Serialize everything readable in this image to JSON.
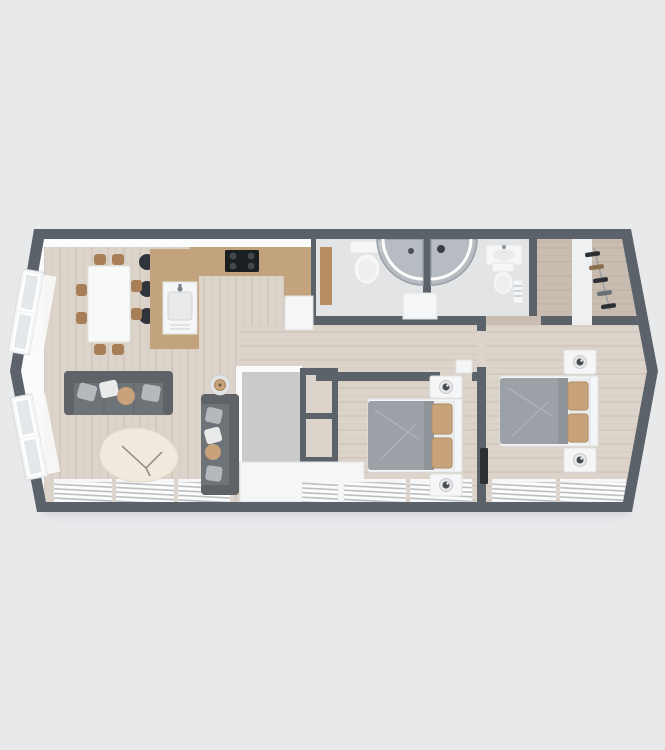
{
  "canvas": {
    "width": 665,
    "height": 750
  },
  "palette": {
    "bg": "#e8e9eb",
    "wall": "#5c6269",
    "wallFace": "#fafbfb",
    "floorMain": "#dcd4ca",
    "floorBath": "#e2e4e6",
    "floorDress": "#c9bdb1",
    "floorNook": "#c9cacc",
    "wood": "#c3a37d",
    "woodTrim": "#b68e62",
    "chairWood": "#a87f56",
    "white": "#f5f6f7",
    "sofa": "#6e7377",
    "sofaDark": "#5f6367",
    "cushionGray": "#b5b9be",
    "cushionWhite": "#e9eaea",
    "tan": "#c7a27a",
    "duvet": "#9ba1a6",
    "duvetFold": "#b2b8bc",
    "dark": "#2c3034",
    "glass": "rgba(130,140,150,0.45)",
    "stripe": "#b9bdc0",
    "rug": "#f0eade",
    "plank": "rgba(135,110,85,0.10)"
  },
  "scene": {
    "type": "3d-floorplan-top-down-render",
    "building": "single-storey-holiday-lodge",
    "rooms": [
      {
        "name": "open-plan-living-kitchen-diner",
        "furniture": [
          "dining-table",
          "dining-chairs-x8",
          "kitchen-counter-with-hob",
          "fridge-unit",
          "breakfast-bar-with-sink",
          "bar-stools-x3",
          "three-seat-sofa",
          "two-seat-sofa",
          "round-side-table-with-lamp",
          "cream-rug",
          "casement-windows-x2",
          "radiator-panels-x3"
        ]
      },
      {
        "name": "family-bathroom",
        "furniture": [
          "toilet",
          "corner-quadrant-shower",
          "timber-vanity-shelf",
          "storage-unit"
        ]
      },
      {
        "name": "shower-room",
        "furniture": [
          "corner-quadrant-shower",
          "washbasin",
          "toilet",
          "towel-radiator"
        ]
      },
      {
        "name": "dressing-room",
        "furniture": [
          "clothes-rail-with-hanging-clothes"
        ]
      },
      {
        "name": "hallway",
        "furniture": [
          "open-shelf-unit",
          "storage-cupboard",
          "linen-nook"
        ]
      },
      {
        "name": "bedroom-two",
        "furniture": [
          "double-bed",
          "bedside-cabinets-x2",
          "table-lamps-x2",
          "wardrobe",
          "radiator-panels-x2"
        ]
      },
      {
        "name": "master-bedroom",
        "furniture": [
          "double-bed",
          "bedside-cabinets-x2",
          "table-lamps-x2",
          "wall-tv",
          "radiator-panels-x2"
        ]
      }
    ]
  }
}
